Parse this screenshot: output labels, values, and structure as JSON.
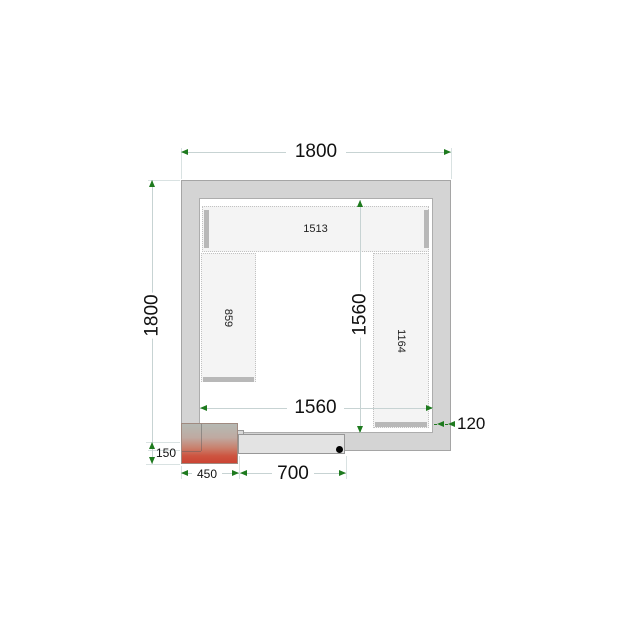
{
  "diagram": {
    "kind": "cold-room floor plan",
    "dimensions": {
      "top_width": "1800",
      "left_height": "1800",
      "inner_width": "1560",
      "inner_height": "1560",
      "wall_thickness": "120",
      "unit_offset": "150",
      "unit_width": "450",
      "door_width": "700"
    },
    "shelves": {
      "top_length": "1513",
      "left_length": "859",
      "right_length": "1164"
    },
    "colors": {
      "wall_fill": "#d4d4d4",
      "shelf_fill": "#f4f4f4",
      "shelf_edge": "#b8b8b8",
      "dimension_line": "#c7d3d3",
      "arrow_green": "#1e7a1e",
      "unit_red": "#cc4433",
      "door_fill": "#e3e3e3",
      "handle_dot": "#000000"
    }
  }
}
